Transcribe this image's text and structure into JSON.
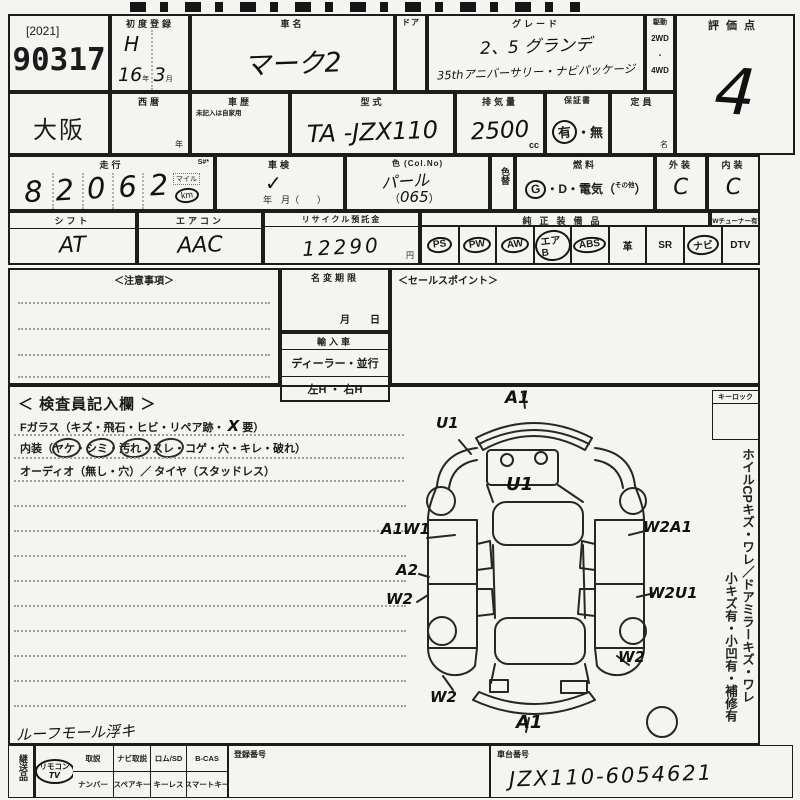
{
  "sheet": {
    "lot": {
      "year_tag": "[2021]",
      "number": "90317"
    },
    "auction_house": "大阪",
    "first_registration": {
      "label": "初度登録",
      "era": "H",
      "year": "16",
      "year_unit": "年",
      "month": "3",
      "month_unit": "月"
    },
    "western_year": {
      "label": "西暦",
      "unit": "年"
    },
    "car_history": {
      "label": "車歴",
      "note": "未記入は自家用"
    },
    "car_name": {
      "label": "車名",
      "value": "マーク2"
    },
    "door": {
      "label": "ドア"
    },
    "grade": {
      "label": "グレード",
      "line1": "2、5 グランデ",
      "line2": "35thアニバーサリー・ナビパッケージ"
    },
    "drive": {
      "label": "駆動",
      "opt1": "2WD",
      "dot": "・",
      "opt2": "4WD"
    },
    "score": {
      "label": "評価点",
      "value": "4"
    },
    "model": {
      "label": "型式",
      "value": "TA -JZX110"
    },
    "displacement": {
      "label": "排気量",
      "value": "2500",
      "unit": "cc"
    },
    "warranty": {
      "label": "保証書",
      "yes": "有",
      "sep": "・",
      "no": "無"
    },
    "capacity": {
      "label": "定員",
      "unit": "名"
    },
    "mileage": {
      "label": "走行",
      "s_label": "S#*",
      "value": "82062",
      "unit_mile": "マイル",
      "unit_km": "km"
    },
    "shaken": {
      "label": "車検",
      "check": "✓",
      "line": "年　月（　　）"
    },
    "color": {
      "label": "色 (Col.No)",
      "value": "パール",
      "paren_open": "（",
      "code": "065",
      "paren_close": "）",
      "change_label": "色替"
    },
    "fuel": {
      "label": "燃料",
      "g": "G",
      "rest": "・D・電気（",
      "other": "その他",
      "close": "）"
    },
    "exterior": {
      "label": "外装",
      "value": "C"
    },
    "interior_grade": {
      "label": "内装",
      "value": "C"
    },
    "shift": {
      "label": "シフト",
      "value": "AT"
    },
    "aircon": {
      "label": "エアコン",
      "value": "AAC"
    },
    "recycle": {
      "label": "リサイクル預託金",
      "value": "12290",
      "unit": "円"
    },
    "equipment": {
      "label": "純正装備品",
      "tuner_label": "Wチューナー有",
      "items": [
        {
          "label": "PS",
          "circled": true
        },
        {
          "label": "PW",
          "circled": true
        },
        {
          "label": "AW",
          "circled": true
        },
        {
          "label": "エアB",
          "circled": true
        },
        {
          "label": "ABS",
          "circled": true
        },
        {
          "label": "革",
          "circled": false
        },
        {
          "label": "SR",
          "circled": false
        },
        {
          "label": "ナビ",
          "circled": true
        },
        {
          "label": "DTV",
          "circled": false
        }
      ]
    },
    "notes": {
      "label": "＜注意事項＞"
    },
    "name_change": {
      "label": "名変期限",
      "line": "月　　日"
    },
    "import_car": {
      "label": "輸入車",
      "line1": "ディーラー・並行",
      "line2": "左H ・ 右H"
    },
    "sales_point": {
      "label": "＜セールスポイント＞"
    },
    "inspector": {
      "label": "＜ 検査員記入欄 ＞",
      "glass_prefix": "Fガラス（キズ・飛石・ヒビ・リペア跡・",
      "glass_mark": "X",
      "glass_suffix": "要）",
      "interior_line": "内装（ヤケ・シミ・汚れ・スレ・コゲ・穴・キレ・破れ）",
      "audio_line": "オーディオ（無し・穴）／ タイヤ（スタッドレス）"
    },
    "key_lock": {
      "label": "キーロック"
    },
    "side_note_1": "ホイルCPキズ・ワレ／ドアミラーキズ・ワレ",
    "side_note_2": "小キズ有・小凹有・補修有",
    "damage_labels": [
      {
        "text": "A1"
      },
      {
        "text": "U1"
      },
      {
        "text": "U1"
      },
      {
        "text": "A1W1"
      },
      {
        "text": "A2"
      },
      {
        "text": "W2"
      },
      {
        "text": "W2"
      },
      {
        "text": "W2A1"
      },
      {
        "text": "W2U1"
      },
      {
        "text": "W2"
      },
      {
        "text": "A1"
      }
    ],
    "bottom_note": "ルーフモール浮キ",
    "accessories": {
      "label": "継送品",
      "row1": [
        "取説",
        "ナビ取説",
        "ロム/SD",
        "B-CAS"
      ],
      "row2": [
        "ナンバー",
        "スペアキー",
        "キーレス",
        "スマートキー"
      ],
      "remote_line1": "リモコン",
      "remote_line2": "TV"
    },
    "registration_no": {
      "label": "登録番号"
    },
    "chassis_no": {
      "label": "車台番号",
      "value": "JZX110-6054621"
    }
  }
}
